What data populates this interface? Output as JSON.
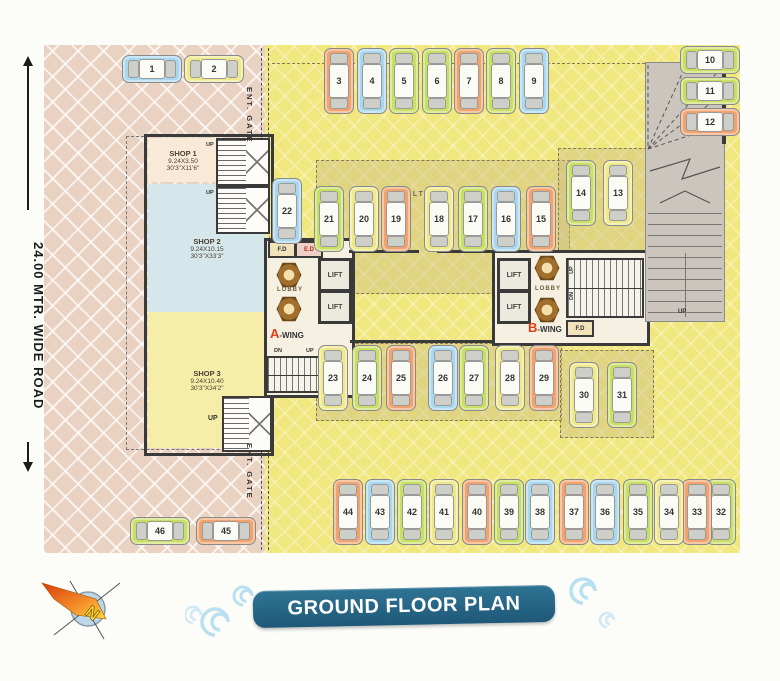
{
  "title": "GROUND FLOOR PLAN",
  "compass": {
    "north": "N"
  },
  "road": {
    "label": "24.00 MTR. WIDE ROAD"
  },
  "gates": {
    "top": "ENT. GATE",
    "bottom": "ENT. GATE"
  },
  "labels": {
    "up": "UP",
    "dn": "DN",
    "stilt": "STILT"
  },
  "shops": [
    {
      "name": "SHOP 1",
      "dim_m": "9.24X3.50",
      "dim_ft": "30'3\"X11'6\""
    },
    {
      "name": "SHOP 2",
      "dim_m": "9.24X10.15",
      "dim_ft": "30'3\"X33'3\""
    },
    {
      "name": "SHOP 3",
      "dim_m": "9.24X10.40",
      "dim_ft": "30'3\"X34'2\""
    }
  ],
  "wing_a": {
    "letter": "A",
    "rest": "-WING",
    "lobby": "LOBBY",
    "lift": "LIFT",
    "fd": "F.D",
    "ed": "E.D"
  },
  "wing_b": {
    "letter": "B",
    "rest": "-WING",
    "lobby": "LOBBY",
    "lift": "LIFT",
    "fd": "F.D"
  },
  "palette": {
    "blue": "#a9d7ee",
    "green": "#c7e061",
    "orange": "#f2a36d",
    "yellow": "#efe98a"
  },
  "parking": {
    "stalls": [
      {
        "no": "1",
        "color": "blue",
        "o": "h",
        "x": 78,
        "y": 10
      },
      {
        "no": "2",
        "color": "yellow",
        "o": "h",
        "x": 140,
        "y": 10
      },
      {
        "no": "3",
        "color": "orange",
        "o": "v",
        "x": 280,
        "y": 3
      },
      {
        "no": "4",
        "color": "blue",
        "o": "v",
        "x": 313,
        "y": 3
      },
      {
        "no": "5",
        "color": "green",
        "o": "v",
        "x": 345,
        "y": 3
      },
      {
        "no": "6",
        "color": "green",
        "o": "v",
        "x": 378,
        "y": 3
      },
      {
        "no": "7",
        "color": "orange",
        "o": "v",
        "x": 410,
        "y": 3
      },
      {
        "no": "8",
        "color": "green",
        "o": "v",
        "x": 442,
        "y": 3
      },
      {
        "no": "9",
        "color": "blue",
        "o": "v",
        "x": 475,
        "y": 3
      },
      {
        "no": "10",
        "color": "green",
        "o": "h",
        "x": 636,
        "y": 1
      },
      {
        "no": "11",
        "color": "green",
        "o": "h",
        "x": 636,
        "y": 32
      },
      {
        "no": "12",
        "color": "orange",
        "o": "h",
        "x": 636,
        "y": 63
      },
      {
        "no": "13",
        "color": "yellow",
        "o": "v",
        "x": 559,
        "y": 115
      },
      {
        "no": "14",
        "color": "green",
        "o": "v",
        "x": 522,
        "y": 115
      },
      {
        "no": "15",
        "color": "orange",
        "o": "v",
        "x": 482,
        "y": 141
      },
      {
        "no": "16",
        "color": "blue",
        "o": "v",
        "x": 447,
        "y": 141
      },
      {
        "no": "17",
        "color": "green",
        "o": "v",
        "x": 414,
        "y": 141
      },
      {
        "no": "18",
        "color": "yellow",
        "o": "v",
        "x": 380,
        "y": 141
      },
      {
        "no": "19",
        "color": "orange",
        "o": "v",
        "x": 337,
        "y": 141
      },
      {
        "no": "20",
        "color": "yellow",
        "o": "v",
        "x": 305,
        "y": 141
      },
      {
        "no": "21",
        "color": "green",
        "o": "v",
        "x": 270,
        "y": 141
      },
      {
        "no": "22",
        "color": "blue",
        "o": "v",
        "x": 228,
        "y": 133
      },
      {
        "no": "23",
        "color": "yellow",
        "o": "v",
        "x": 274,
        "y": 300
      },
      {
        "no": "24",
        "color": "green",
        "o": "v",
        "x": 308,
        "y": 300
      },
      {
        "no": "25",
        "color": "orange",
        "o": "v",
        "x": 342,
        "y": 300
      },
      {
        "no": "26",
        "color": "blue",
        "o": "v",
        "x": 384,
        "y": 300
      },
      {
        "no": "27",
        "color": "green",
        "o": "v",
        "x": 415,
        "y": 300
      },
      {
        "no": "28",
        "color": "yellow",
        "o": "v",
        "x": 451,
        "y": 300
      },
      {
        "no": "29",
        "color": "orange",
        "o": "v",
        "x": 485,
        "y": 300
      },
      {
        "no": "30",
        "color": "yellow",
        "o": "v",
        "x": 525,
        "y": 317
      },
      {
        "no": "31",
        "color": "green",
        "o": "v",
        "x": 563,
        "y": 317
      },
      {
        "no": "32",
        "color": "green",
        "o": "v",
        "x": 662,
        "y": 434
      },
      {
        "no": "33",
        "color": "orange",
        "o": "v",
        "x": 638,
        "y": 434
      },
      {
        "no": "34",
        "color": "yellow",
        "o": "v",
        "x": 610,
        "y": 434
      },
      {
        "no": "35",
        "color": "green",
        "o": "v",
        "x": 579,
        "y": 434
      },
      {
        "no": "36",
        "color": "blue",
        "o": "v",
        "x": 546,
        "y": 434
      },
      {
        "no": "37",
        "color": "orange",
        "o": "v",
        "x": 515,
        "y": 434
      },
      {
        "no": "38",
        "color": "blue",
        "o": "v",
        "x": 481,
        "y": 434
      },
      {
        "no": "39",
        "color": "green",
        "o": "v",
        "x": 450,
        "y": 434
      },
      {
        "no": "40",
        "color": "orange",
        "o": "v",
        "x": 418,
        "y": 434
      },
      {
        "no": "41",
        "color": "yellow",
        "o": "v",
        "x": 385,
        "y": 434
      },
      {
        "no": "42",
        "color": "green",
        "o": "v",
        "x": 353,
        "y": 434
      },
      {
        "no": "43",
        "color": "blue",
        "o": "v",
        "x": 321,
        "y": 434
      },
      {
        "no": "44",
        "color": "orange",
        "o": "v",
        "x": 289,
        "y": 434
      },
      {
        "no": "45",
        "color": "orange",
        "o": "h",
        "x": 152,
        "y": 472
      },
      {
        "no": "46",
        "color": "green",
        "o": "h",
        "x": 86,
        "y": 472
      }
    ]
  }
}
